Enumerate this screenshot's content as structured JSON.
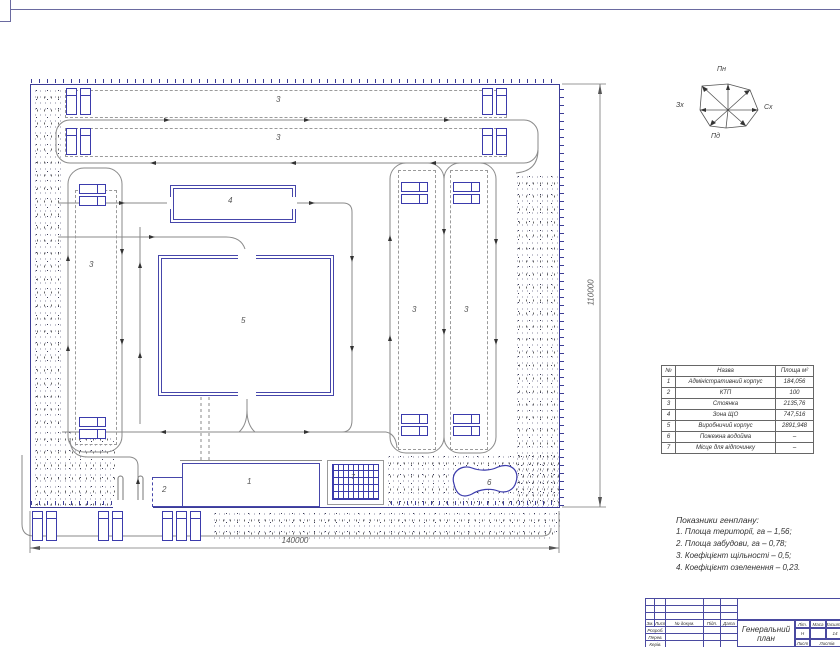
{
  "plan": {
    "labels": {
      "admin": "1",
      "ktp": "2",
      "parking": "3",
      "service_zone": "4",
      "production": "5",
      "pond": "6",
      "rest": "7"
    },
    "dimensions": {
      "width": "140000",
      "height": "110000"
    }
  },
  "compass": {
    "north": "Пн",
    "south": "Пд",
    "west": "Зх",
    "east": "Сх"
  },
  "area_table": {
    "headers": [
      "№",
      "Назва",
      "Площа м²"
    ],
    "rows": [
      [
        "1",
        "Адміністративний корпус",
        "184,056"
      ],
      [
        "2",
        "КТП",
        "100"
      ],
      [
        "3",
        "Стоянка",
        "2135,76"
      ],
      [
        "4",
        "Зона ЩО",
        "747,516"
      ],
      [
        "5",
        "Виробничий корпус",
        "2891,948"
      ],
      [
        "6",
        "Пожежна водойма",
        "–"
      ],
      [
        "7",
        "Місце для відпочинку",
        "–"
      ]
    ]
  },
  "notes": {
    "title": "Показники генплану:",
    "items": [
      "1. Площа території, га – 1,56;",
      "2. Площа забудови, га – 0,78;",
      "3. Коефіцієнт щільності – 0,5;",
      "4. Коефіцієнт озеленення – 0,23."
    ]
  },
  "title_block": {
    "title": "Генеральний план",
    "header_cells": [
      "Зм.",
      "Лист",
      "№ докум.",
      "Підп.",
      "Дата"
    ],
    "row_labels": [
      "Розроб.",
      "Перев.",
      "Керів."
    ],
    "lit_label": "Літ.",
    "mass_label": "Маса",
    "scale_label": "Масштаб",
    "lit_value": "Н",
    "scale_value": "14",
    "sheet_label": "Лист",
    "sheets_label": "Листів"
  },
  "colors": {
    "line_blue": "#4646aa",
    "fence_blue": "#3c3c96",
    "road_gray": "#8a8a8a"
  }
}
